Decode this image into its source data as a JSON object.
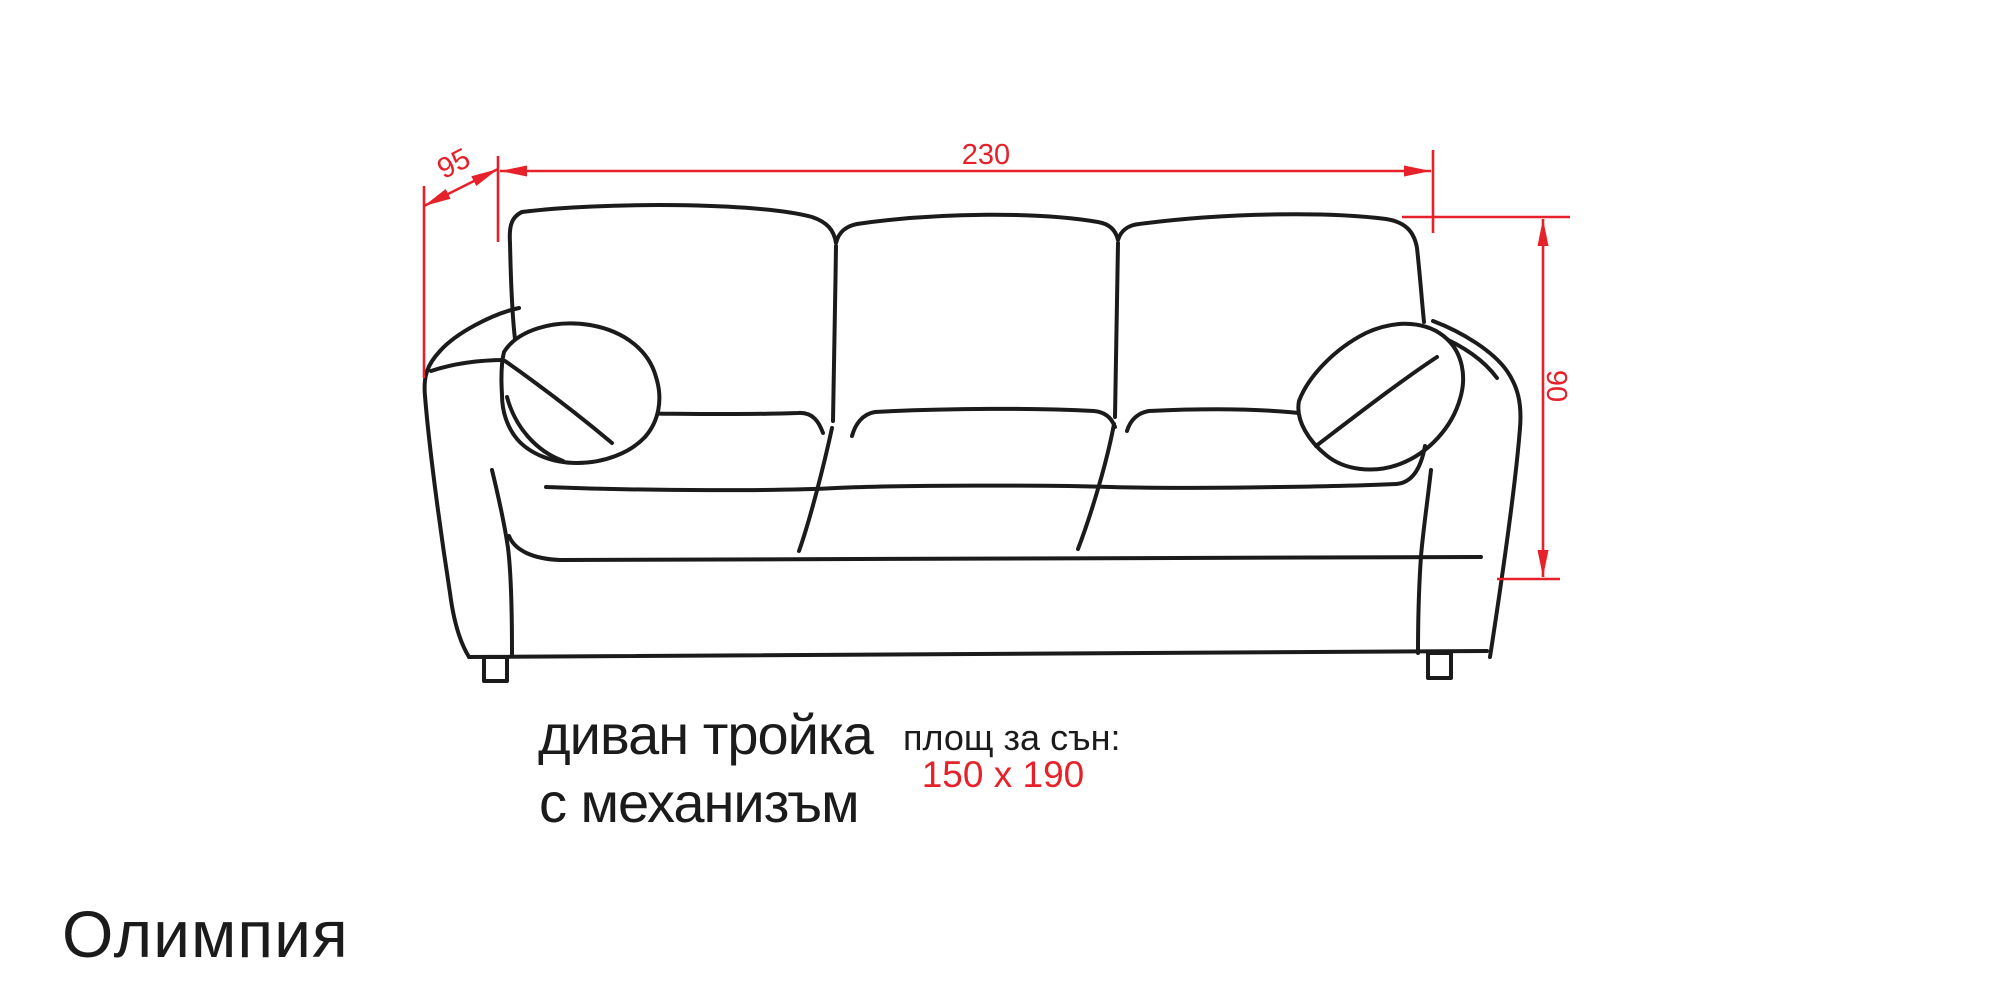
{
  "diagram": {
    "type": "furniture-dimension-drawing",
    "background": "#ffffff",
    "colors": {
      "outline": "#1b1b1b",
      "dimension": "#e62129",
      "caption": "#1b1b1b"
    },
    "dimensions": {
      "width": {
        "value": "230",
        "orientation": "horizontal"
      },
      "depth": {
        "value": "95",
        "orientation": "diagonal"
      },
      "height": {
        "value": "90",
        "orientation": "vertical"
      }
    },
    "captions": {
      "product_type_line1": "диван тройка",
      "product_type_line2": "с механизъм",
      "sleeping_area_label": "площ за сън:",
      "sleeping_area_value": "150 x 190"
    },
    "product_name": "Олимпия"
  }
}
